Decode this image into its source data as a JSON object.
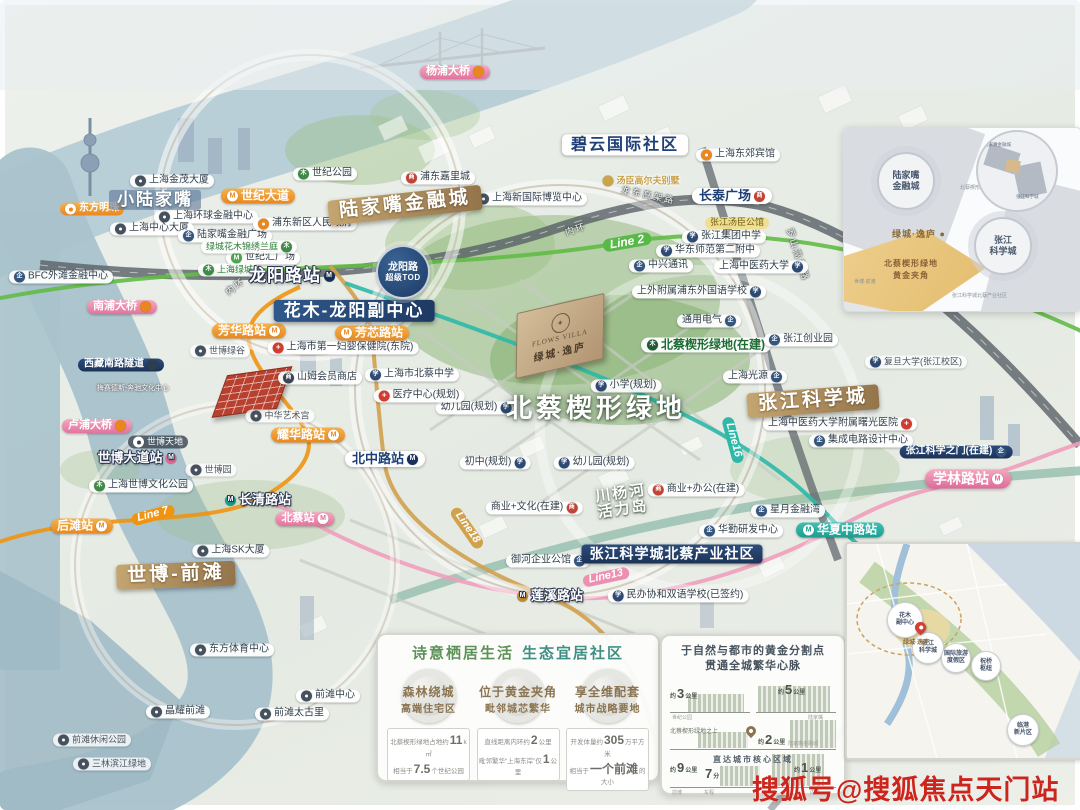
{
  "watermark": "搜狐号@搜狐焦点天门站",
  "project": {
    "brand_en": "FLOWS VILLA",
    "brand_cn": "绿城·逸庐"
  },
  "tod_badge": {
    "line1": "龙阳路",
    "line2": "超级TOD"
  },
  "map": {
    "labels": [
      {
        "t": "小陆家嘴",
        "x": 155,
        "y": 200,
        "type": "big-blue"
      },
      {
        "t": "世纪大道",
        "x": 258,
        "y": 196,
        "type": "station-orange",
        "icon": "metro-w-orange"
      },
      {
        "t": "陆家嘴金融城",
        "x": 405,
        "y": 205,
        "type": "gold-lg",
        "rot": -6
      },
      {
        "t": "碧云国际社区",
        "x": 625,
        "y": 145,
        "type": "white-navy-lg"
      },
      {
        "t": "花木-龙阳副中心",
        "x": 354,
        "y": 311,
        "type": "navy-lg"
      },
      {
        "t": "北蔡楔形绿地",
        "x": 596,
        "y": 408,
        "type": "big-white"
      },
      {
        "t": "张江科学城",
        "x": 813,
        "y": 401,
        "type": "gold-lg",
        "rot": -4
      },
      {
        "t": "世博-前滩",
        "x": 176,
        "y": 575,
        "type": "gold-lg",
        "rot": -2
      },
      {
        "t": "张江科学城北蔡产业社区",
        "x": 672,
        "y": 554,
        "type": "navy-md"
      },
      {
        "lines": [
          "川杨河",
          "活力岛"
        ],
        "x": 622,
        "y": 502,
        "type": "big-white-sm",
        "rot": -8
      },
      {
        "t": "杨浦大桥",
        "x": 455,
        "y": 72,
        "type": "station-pink",
        "icon2": "dot-orange"
      },
      {
        "t": "南浦大桥",
        "x": 122,
        "y": 307,
        "type": "station-pink",
        "icon2": "dot-orange"
      },
      {
        "t": "卢浦大桥",
        "x": 97,
        "y": 426,
        "type": "station-pink",
        "icon2": "dot-orange"
      },
      {
        "t": "西藏南路隧道",
        "x": 121,
        "y": 365,
        "type": "navy-sm",
        "icon2": "dot-dark"
      },
      {
        "t": "龙阳路站",
        "x": 292,
        "y": 276,
        "type": "station-hero",
        "icon2": "metro-navy"
      },
      {
        "t": "芳华路站",
        "x": 249,
        "y": 331,
        "type": "station-orange",
        "icon2": "metro-w-orange"
      },
      {
        "t": "芳芯路站",
        "x": 372,
        "y": 333,
        "type": "station-orange",
        "icon": "metro-w-orange"
      },
      {
        "t": "耀华路站",
        "x": 308,
        "y": 435,
        "type": "station-orange",
        "icon2": "metro-w-orange"
      },
      {
        "t": "后滩站",
        "x": 82,
        "y": 526,
        "type": "station-orange",
        "icon2": "metro-w-orange"
      },
      {
        "t": "Line 7",
        "x": 153,
        "y": 515,
        "type": "line-orange",
        "rot": -15
      },
      {
        "t": "世博大道站",
        "x": 137,
        "y": 458,
        "type": "station-hero-sm",
        "icon2": "metro-pink"
      },
      {
        "t": "长清路站",
        "x": 258,
        "y": 500,
        "type": "station-hero-sm",
        "icon": "metro-teal"
      },
      {
        "t": "北蔡站",
        "x": 305,
        "y": 519,
        "type": "station-pink",
        "icon2": "metro-w-pink"
      },
      {
        "t": "北中路站",
        "x": 385,
        "y": 459,
        "type": "white-navy",
        "icon2": "metro-navy"
      },
      {
        "t": "莲溪路站",
        "x": 550,
        "y": 596,
        "type": "station-hero-sm",
        "icon": "metro-gold"
      },
      {
        "t": "学林路站",
        "x": 968,
        "y": 479,
        "type": "station-pink-lg",
        "icon2": "metro-w-pink"
      },
      {
        "t": "华夏中路站",
        "x": 840,
        "y": 530,
        "type": "station-teal",
        "icon": "metro-w-teal"
      },
      {
        "t": "Line 2",
        "x": 627,
        "y": 242,
        "type": "line-green",
        "rot": -10
      },
      {
        "t": "Line16",
        "x": 733,
        "y": 440,
        "type": "line-teal",
        "rot": 75
      },
      {
        "t": "Line13",
        "x": 606,
        "y": 577,
        "type": "line-pink",
        "rot": -12
      },
      {
        "t": "Line18",
        "x": 467,
        "y": 528,
        "type": "line-gold",
        "rot": 55
      },
      {
        "t": "东方明珠",
        "x": 92,
        "y": 209,
        "type": "station-orange-sm",
        "icon": "pin-w"
      },
      {
        "t": "上海金茂大厦",
        "x": 172,
        "y": 181,
        "type": "pill",
        "icon": "pin"
      },
      {
        "t": "上海环球金融中心",
        "x": 206,
        "y": 217,
        "type": "pill",
        "icon": "pin"
      },
      {
        "t": "上海中心大厦",
        "x": 152,
        "y": 229,
        "type": "pill",
        "icon": "pin"
      },
      {
        "t": "陆家嘴金融广场",
        "x": 225,
        "y": 236,
        "type": "pill",
        "icon": "office"
      },
      {
        "t": "世纪汇广场",
        "x": 263,
        "y": 258,
        "type": "pill",
        "icon": "metro-green"
      },
      {
        "t": "绿城花木锦绣兰庭",
        "x": 249,
        "y": 247,
        "type": "pill-green",
        "icon2": "park"
      },
      {
        "t": "上海绿城",
        "x": 228,
        "y": 270,
        "type": "pill-green",
        "icon": "park"
      },
      {
        "t": "浦东新区人民政府",
        "x": 305,
        "y": 224,
        "type": "pill",
        "icon": "pin-o"
      },
      {
        "t": "世纪公园",
        "x": 325,
        "y": 174,
        "type": "pill",
        "icon": "park"
      },
      {
        "t": "BFC外滩金融中心",
        "x": 61,
        "y": 277,
        "type": "pill",
        "icon": "office"
      },
      {
        "t": "浦东嘉里城",
        "x": 438,
        "y": 178,
        "type": "pill",
        "icon": "mall"
      },
      {
        "t": "上海新国际博览中心",
        "x": 530,
        "y": 199,
        "type": "pill",
        "icon": "pin"
      },
      {
        "t": "上海东郊宾馆",
        "x": 738,
        "y": 155,
        "type": "pill",
        "icon": "pin-o"
      },
      {
        "t": "汤臣高尔夫别墅",
        "x": 641,
        "y": 181,
        "type": "gold-text",
        "icon": "dot-gold"
      },
      {
        "t": "长泰广场",
        "x": 732,
        "y": 196,
        "type": "white-navy",
        "icon2": "mall"
      },
      {
        "t": "张江汤臣公馆",
        "x": 737,
        "y": 223,
        "type": "pill-yellow"
      },
      {
        "t": "张江集团中学",
        "x": 724,
        "y": 237,
        "type": "pill",
        "icon": "school"
      },
      {
        "t": "华东师范第二附中",
        "x": 708,
        "y": 251,
        "type": "pill",
        "icon": "school"
      },
      {
        "t": "中兴通讯",
        "x": 661,
        "y": 266,
        "type": "pill",
        "icon": "office"
      },
      {
        "t": "上海中医药大学",
        "x": 761,
        "y": 267,
        "type": "pill",
        "icon2": "school"
      },
      {
        "t": "上外附属浦东外国语学校",
        "x": 699,
        "y": 292,
        "type": "pill",
        "icon2": "school"
      },
      {
        "t": "通用电气",
        "x": 709,
        "y": 321,
        "type": "pill",
        "icon2": "office"
      },
      {
        "t": "北蔡楔形绿地(在建)",
        "x": 706,
        "y": 345,
        "type": "pill-green-lg",
        "icon": "park-dk"
      },
      {
        "t": "上海光源",
        "x": 755,
        "y": 377,
        "type": "pill",
        "icon2": "office"
      },
      {
        "t": "张江创业园",
        "x": 801,
        "y": 340,
        "type": "pill",
        "icon": "office"
      },
      {
        "t": "复旦大学(张江校区)",
        "x": 916,
        "y": 362,
        "type": "pill-faint",
        "icon": "school"
      },
      {
        "t": "上海中医药大学附属曙光医院",
        "x": 840,
        "y": 424,
        "type": "pill",
        "icon2": "hospital"
      },
      {
        "t": "集成电路设计中心",
        "x": 861,
        "y": 441,
        "type": "pill",
        "icon": "office"
      },
      {
        "t": "张江科学之门(在建)",
        "x": 956,
        "y": 452,
        "type": "navy-sm",
        "icon2": "office"
      },
      {
        "t": "星月金融湾",
        "x": 788,
        "y": 511,
        "type": "pill",
        "icon": "office"
      },
      {
        "t": "华勤研发中心",
        "x": 741,
        "y": 531,
        "type": "pill",
        "icon": "office"
      },
      {
        "t": "御河企业公馆",
        "x": 548,
        "y": 561,
        "type": "pill",
        "icon2": "office"
      },
      {
        "t": "民办协和双语学校(已签约)",
        "x": 678,
        "y": 596,
        "type": "pill",
        "icon": "school"
      },
      {
        "t": "商业+文化(在建)",
        "x": 534,
        "y": 508,
        "type": "pill",
        "icon2": "mall"
      },
      {
        "t": "商业+办公(在建)",
        "x": 696,
        "y": 490,
        "type": "pill",
        "icon": "mall"
      },
      {
        "t": "小学(规划)",
        "x": 626,
        "y": 386,
        "type": "pill",
        "icon": "school"
      },
      {
        "t": "幼儿园(规划)",
        "x": 476,
        "y": 408,
        "type": "pill",
        "icon2": "school"
      },
      {
        "t": "幼儿园(规划)",
        "x": 594,
        "y": 463,
        "type": "pill",
        "icon": "school"
      },
      {
        "t": "初中(规划)",
        "x": 495,
        "y": 463,
        "type": "pill",
        "icon2": "school"
      },
      {
        "t": "医疗中心(规划)",
        "x": 419,
        "y": 396,
        "type": "pill",
        "icon": "hospital"
      },
      {
        "t": "上海市北蔡中学",
        "x": 412,
        "y": 375,
        "type": "pill",
        "icon": "school"
      },
      {
        "t": "上海市第一妇婴保健院(东院)",
        "x": 343,
        "y": 348,
        "type": "pill",
        "icon": "hospital"
      },
      {
        "t": "山姆会员商店",
        "x": 320,
        "y": 378,
        "type": "pill",
        "icon": "mall-dk"
      },
      {
        "t": "中华艺术宫",
        "x": 280,
        "y": 416,
        "type": "pill-faint",
        "icon": "pin"
      },
      {
        "t": "世博绿谷",
        "x": 220,
        "y": 351,
        "type": "pill-faint",
        "icon": "pin"
      },
      {
        "t": "世博园",
        "x": 211,
        "y": 470,
        "type": "pill-faint",
        "icon": "pin"
      },
      {
        "t": "世博天地",
        "x": 158,
        "y": 442,
        "type": "pill-dark",
        "icon": "pin-w2"
      },
      {
        "t": "上海世博文化公园",
        "x": 141,
        "y": 486,
        "type": "pill",
        "icon": "park"
      },
      {
        "t": "梅赛德斯-奔驰文化中心",
        "x": 133,
        "y": 389,
        "type": "text-white-sm"
      },
      {
        "t": "上海SK大厦",
        "x": 231,
        "y": 551,
        "type": "pill",
        "icon": "pin"
      },
      {
        "t": "东方体育中心",
        "x": 232,
        "y": 650,
        "type": "pill",
        "icon": "pin"
      },
      {
        "t": "前滩中心",
        "x": 328,
        "y": 696,
        "type": "pill",
        "icon": "pin"
      },
      {
        "t": "前滩太古里",
        "x": 292,
        "y": 714,
        "type": "pill",
        "icon": "pin"
      },
      {
        "t": "晶耀前滩",
        "x": 178,
        "y": 712,
        "type": "pill",
        "icon": "pin"
      },
      {
        "t": "前滩休闲公园",
        "x": 92,
        "y": 740,
        "type": "pill-faint",
        "icon": "pin"
      },
      {
        "t": "三林滨江绿地",
        "x": 112,
        "y": 764,
        "type": "pill-faint",
        "icon": "pin"
      },
      {
        "t": "内环",
        "x": 236,
        "y": 287,
        "type": "road",
        "rot": -38
      },
      {
        "t": "内环",
        "x": 576,
        "y": 230,
        "type": "road",
        "rot": -18
      },
      {
        "t": "龙东高架路",
        "x": 648,
        "y": 196,
        "type": "road",
        "rot": 12
      },
      {
        "t": "罗山高架路",
        "x": 797,
        "y": 255,
        "type": "road",
        "rot": 72
      }
    ]
  },
  "inset_top_right": {
    "rings": [
      [
        "陆家嘴",
        "金融城"
      ],
      [
        "张江",
        "科学城"
      ]
    ],
    "area_label": "绿城·逸庐 ●",
    "area_sub1": "北蔡楔形绿地",
    "area_sub2": "黄金夹角",
    "tiny_mid": "北蔡楔形绿地",
    "tiny_left": "世博·前滩",
    "tiny_bottom": "张江科学城北蔡产业社区",
    "mag1": "陆家嘴金融城",
    "mag2": "张江科学城"
  },
  "panel_eco": {
    "title1": "诗意栖居生活",
    "title2": "生态宜居社区",
    "cols": [
      {
        "h1": "森林绕城",
        "h2": "高端住宅区",
        "s1_pre": "北蔡楔形绿地占地约",
        "s1_big": "11",
        "s1_suf": "k㎡",
        "s2_pre": "相当于",
        "s2_big": "7.5",
        "s2_suf": "个世纪公园"
      },
      {
        "h1": "位于黄金夹角",
        "h2": "毗邻城芯繁华",
        "s1_pre": "直线距离内环约",
        "s1_big": "2",
        "s1_suf": "公里",
        "s2_pre": "毗邻繁华“上海东岸”仅",
        "s2_big": "1",
        "s2_suf": "公里"
      },
      {
        "h1": "享全维配套",
        "h2": "城市战略要地",
        "s1_pre": "开发体量约",
        "s1_big": "305",
        "s1_suf": "万平方米",
        "s2_pre": "相当于",
        "s2_big": "一个前滩",
        "s2_suf": "的大小"
      }
    ]
  },
  "panel_golden": {
    "title1": "于自然与都市的黄金分割点",
    "title2": "贯通全城繁华心脉",
    "note_left": "北蔡楔形绿地之上",
    "note_center": "直达城市核心区域",
    "stats": [
      {
        "pre": "约",
        "big": "3",
        "suf": "公里",
        "cap": "世纪公园"
      },
      {
        "pre": "约",
        "big": "5",
        "suf": "公里",
        "cap": "陆家嘴"
      },
      {
        "pre": "约",
        "big": "2",
        "suf": "公里",
        "cap": "陆家嘴金融城"
      },
      {
        "pre": "约",
        "big": "9",
        "suf": "公里",
        "cap": "前滩"
      },
      {
        "pre": "",
        "big": "7",
        "suf": "分",
        "cap": "车程"
      },
      {
        "pre": "约",
        "big": "1",
        "suf": "公里",
        "cap": "内环"
      }
    ]
  },
  "inset_bottom_right": {
    "pin_label": "绿城·逸庐",
    "nodes": [
      [
        "花木",
        "副中心"
      ],
      [
        "张江",
        "科学城"
      ],
      [
        "国际旅游",
        "度假区"
      ],
      [
        "祝桥",
        "枢纽"
      ],
      [
        "临港",
        "新片区"
      ]
    ]
  }
}
